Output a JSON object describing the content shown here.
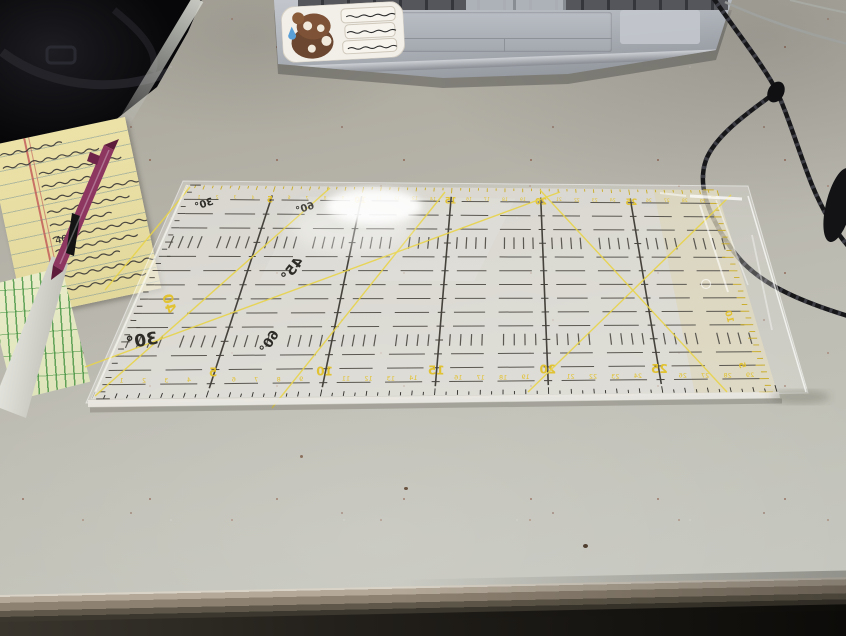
{
  "scene": {
    "description": "Photograph: clear 30 cm quilting ruler in plastic wrap lying face-down on a speckled gray desk, with a silver laptop above, a yellow legal pad with handwriting and a maroon pen at left, a black bag in the top-left corner and braided black cables at right",
    "width": 846,
    "height": 636
  },
  "colors": {
    "desk": "#b3b0a6",
    "desk_edge": "#8d8171",
    "bag": "#0b0b0e",
    "pad_yellow": "#ece2a8",
    "pen_maroon": "#8c3660",
    "laptop_silver": "#aeb2b9",
    "cable_black": "#17171a",
    "green_ruler_marks": "#3d8c3d"
  },
  "bag": {
    "label": "black bag"
  },
  "notepad": {
    "type": "yellow legal pad with handwritten notes",
    "legible_fragments": [
      "40",
      "/44"
    ],
    "scribble_line_count": 12
  },
  "pen": {
    "color_name": "maroon ballpoint pen"
  },
  "laptop": {
    "description": "silver laptop, keyboard and trackpad partially visible",
    "sticker": {
      "description": "sticker: brown cartoon blob with sweat drop",
      "text_lines": 3
    }
  },
  "cables": {
    "description": "black braided cords and thin pale cable"
  },
  "ruler": {
    "kind": "clear quilting ruler, 30 x 15 cm, face down (all markings mirrored), wrapped in plastic",
    "mirrored": true,
    "number_color": "#e2c12b",
    "line_color": "#45423c",
    "dash_color": "#5a5751",
    "diagonal_color": "#e8d44a",
    "label_color": "#2e2c27",
    "bottom_scale": {
      "numbers": [
        1,
        2,
        3,
        4,
        5,
        6,
        7,
        8,
        9,
        10,
        11,
        12,
        13,
        14,
        15,
        16,
        17,
        18,
        19,
        20,
        21,
        22,
        23,
        24,
        25,
        26,
        27,
        28,
        29
      ],
      "bold": [
        5,
        10,
        15,
        20,
        25
      ]
    },
    "top_scale": {
      "numbers": [
        1,
        2,
        3,
        4,
        5,
        6,
        7,
        8,
        9,
        10,
        11,
        12,
        13,
        14,
        15,
        16,
        17,
        18,
        19,
        20,
        21,
        22,
        23,
        24,
        25,
        26,
        27,
        28,
        29
      ],
      "bold": [
        5,
        10,
        15,
        20,
        25
      ]
    },
    "left_scale": {
      "visible_number": "40"
    },
    "right_scale": {
      "visible_numbers": [
        {
          "text": "10",
          "t": 0.63
        },
        {
          "text": "5",
          "t": 0.87
        }
      ]
    },
    "angle_labels": [
      {
        "text": "30°",
        "x": 205,
        "y": 207,
        "size": 10,
        "rot": -18
      },
      {
        "text": "60°",
        "x": 306,
        "y": 211,
        "size": 10,
        "rot": -18
      },
      {
        "text": "45°",
        "x": 296,
        "y": 272,
        "size": 14,
        "rot": -52
      },
      {
        "text": "60°",
        "x": 273,
        "y": 344,
        "size": 13,
        "rot": -58
      },
      {
        "text": "30°",
        "x": 143,
        "y": 346,
        "size": 17,
        "rot": -10
      }
    ],
    "diagonals": [
      [
        330,
        188,
        95,
        396
      ],
      [
        85,
        367,
        560,
        192
      ],
      [
        272,
        408,
        445,
        192
      ],
      [
        190,
        187,
        105,
        290
      ],
      [
        540,
        190,
        727,
        392
      ],
      [
        731,
        195,
        528,
        392
      ]
    ],
    "grid": {
      "columns_cm": 30,
      "rows_cm": 15,
      "major_every_cm": 5
    }
  }
}
